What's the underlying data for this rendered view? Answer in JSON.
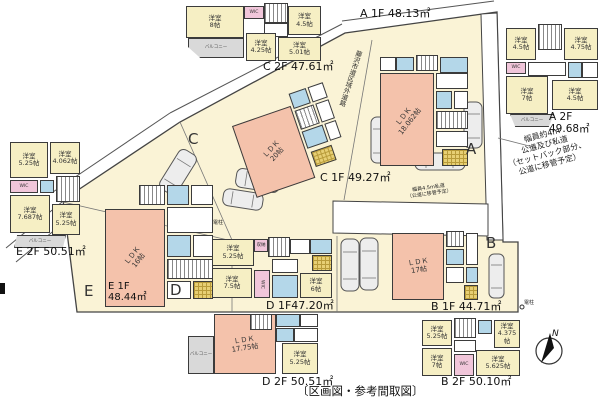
{
  "caption": "〔区画図・参考間取図〕",
  "compass": {
    "north": "N"
  },
  "colors": {
    "site_fill": "#faf3d6",
    "ldk_pink": "#f4c2ab",
    "room_yellow": "#f6efc4",
    "wic_pink": "#f1c6da",
    "bath_blue": "#b4d7e9",
    "balcony_gray": "#d9d9d9",
    "entry_tile": "#e7cf74",
    "line": "#3b3b3b"
  },
  "site": {
    "letters": {
      "a": "A",
      "b": "B",
      "c": "C",
      "d": "D",
      "e": "E"
    },
    "notes": {
      "road_right": "幅員約4m\n公道及び私道\n（セットバック部分、\n公道に移管予定）",
      "road_center": "幅員4.5m私道\n（公道に移管予定）",
      "road_top": "藤沢市道区域外道路",
      "pole1": "電柱",
      "pole2": "電柱"
    }
  },
  "plans": {
    "a1f": {
      "label": "A 1F 48.13㎡",
      "ldk": "ＬＤＫ\n18.062帖"
    },
    "a2f": {
      "label": "A 2F\n49.68㎡",
      "rooms": {
        "r1": "洋室\n4.5帖",
        "r2": "洋室\n4.75帖",
        "wic": "WIC",
        "r3": "洋室\n7帖",
        "r4": "洋室\n4.5帖",
        "balcony": "バルコニー"
      }
    },
    "b1f": {
      "label": "B 1F 44.71㎡",
      "ldk": "ＬＤＫ\n17帖"
    },
    "b2f": {
      "label": "B 2F 50.10㎡",
      "rooms": {
        "r1": "洋室\n5.25帖",
        "r2": "洋室\n4.375帖",
        "r3": "洋室\n7帖",
        "wic": "WIC",
        "r4": "洋室\n5.625帖"
      }
    },
    "c1f": {
      "label": "C 1F 49.27㎡",
      "ldk": "ＬＤＫ\n20帖"
    },
    "c2f": {
      "label": "C 2F 47.61㎡",
      "rooms": {
        "r1": "洋室\n8帖",
        "wic": "WIC",
        "r2": "洋室\n4.5帖",
        "r3": "洋室\n4.25帖",
        "r4": "洋室\n5.01帖",
        "balcony": "バルコニー"
      }
    },
    "d1f": {
      "label": "D 1F47.20㎡",
      "rooms": {
        "r1": "洋室\n5.25帖",
        "closet": "収納",
        "r2": "洋室\n7.5帖",
        "wic": "WIC",
        "r3": "洋室\n6帖"
      }
    },
    "d2f": {
      "label": "D 2F 50.51㎡",
      "ldk": "ＬＤＫ\n17.75帖",
      "rooms": {
        "r1": "洋室\n5.25帖",
        "balcony": "バルコニー"
      }
    },
    "e1f": {
      "label": "E 1F\n48.44㎡",
      "ldk": "ＬＤＫ\n16帖"
    },
    "e2f": {
      "label": "E 2F 50.51㎡",
      "rooms": {
        "r1": "洋室\n5.25帖",
        "r2": "洋室\n4.062帖",
        "wic": "WIC",
        "r3": "洋室\n7.687帖",
        "r4": "洋室\n5.25帖",
        "balcony": "バルコニー"
      }
    }
  }
}
